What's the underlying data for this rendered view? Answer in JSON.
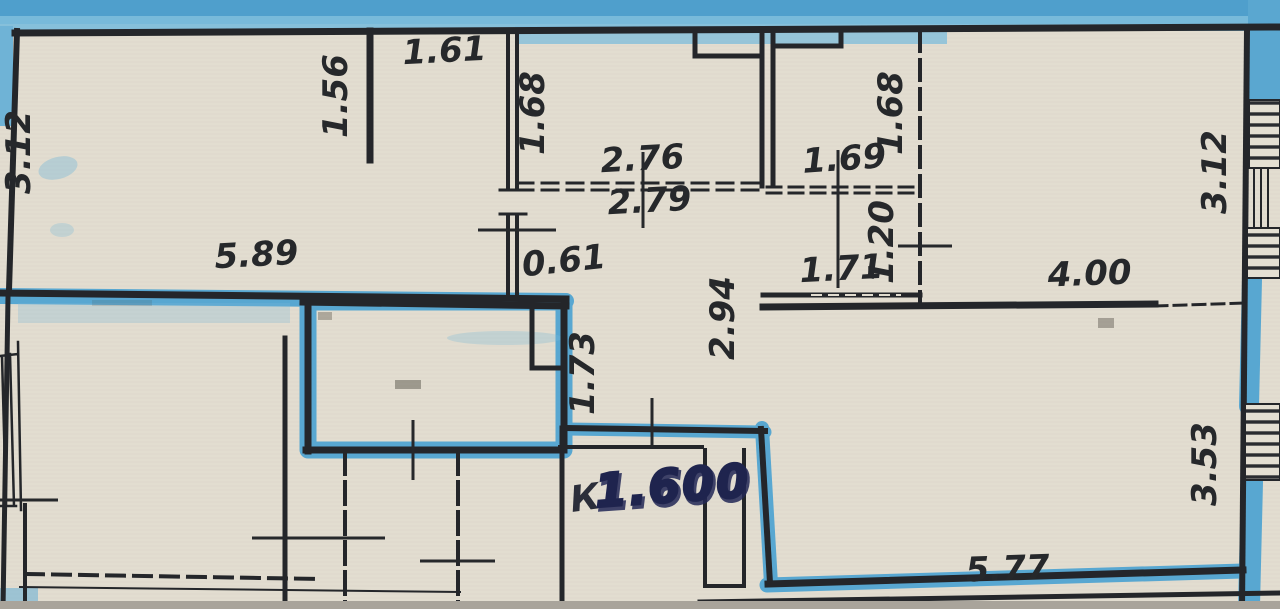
{
  "document": {
    "kind": "scanned apartment floor plan photo with blue highlighter over walls",
    "units": "meters"
  },
  "colors": {
    "paper": "#e2ddd0",
    "wall": "#24262a",
    "highlighter": "#59a8d1",
    "highlighter_light": "#8ec4de",
    "handwriting_ink": "#232856",
    "dimension_text": "#26282b",
    "photo_edge": "#a9a49b"
  },
  "dims": {
    "top_left_height": "3.12",
    "closet_depth": "1.56",
    "closet_width": "1.61",
    "mid_top_height": "1.68",
    "mid_width_upper": "2.76",
    "mid_width_lower": "2.79",
    "right_small_width": "1.69",
    "right_small_height": "1.68",
    "bedroom_height": "3.12",
    "top_left_width": "5.89",
    "niche_width": "0.61",
    "hall_height": "2.94",
    "hall_left_height": "1.73",
    "pantry_width": "1.71",
    "pantry_height": "1.20",
    "bedroom_width": "4.00",
    "bottom_right_height": "3.53",
    "bottom_right_width": "5.77"
  },
  "annotation": {
    "prefix": "К",
    "value": "1.600"
  }
}
